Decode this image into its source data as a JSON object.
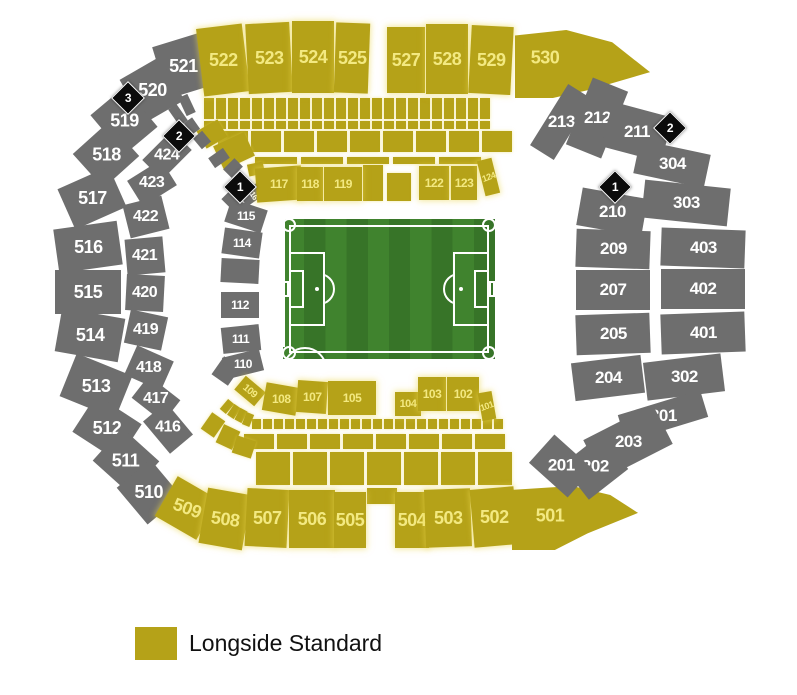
{
  "legend": {
    "label": "Longside Standard",
    "swatch_color": "#b5a218"
  },
  "colors": {
    "longside_standard": "#b5a218",
    "unavailable_gray": "#6e6e6e",
    "yellow_label_text": "#f3e981",
    "gray_label_text": "#ffffff",
    "marker_bg": "#0b0b0b",
    "pitch_green_light": "#40832e",
    "pitch_green_dark": "#377428",
    "pitch_line": "#ffffff"
  },
  "pitch": {
    "x": 283,
    "y": 219,
    "w": 212,
    "h": 140
  },
  "markers": [
    {
      "label": "3",
      "cx": 127,
      "cy": 97
    },
    {
      "label": "2",
      "cx": 178,
      "cy": 135
    },
    {
      "label": "1",
      "cx": 239,
      "cy": 186
    },
    {
      "label": "2",
      "cx": 669,
      "cy": 127
    },
    {
      "label": "1",
      "cx": 614,
      "cy": 186
    }
  ],
  "sections": [
    {
      "label": "521",
      "cx": 183,
      "cy": 66,
      "w": 48,
      "h": 54,
      "r": -17,
      "c": "g",
      "fs": 18
    },
    {
      "label": "522",
      "cx": 223,
      "cy": 60,
      "w": 46,
      "h": 68,
      "r": -7,
      "c": "y",
      "fs": 18
    },
    {
      "label": "523",
      "cx": 269,
      "cy": 58,
      "w": 44,
      "h": 70,
      "r": -3,
      "c": "y",
      "fs": 18
    },
    {
      "label": "524",
      "cx": 313,
      "cy": 57,
      "w": 42,
      "h": 72,
      "r": 0,
      "c": "y",
      "fs": 18
    },
    {
      "label": "525",
      "cx": 352,
      "cy": 58,
      "w": 34,
      "h": 70,
      "r": 2,
      "c": "y",
      "fs": 18
    },
    {
      "label": "527",
      "cx": 406,
      "cy": 60,
      "w": 38,
      "h": 66,
      "r": 0,
      "c": "y",
      "fs": 18
    },
    {
      "label": "528",
      "cx": 447,
      "cy": 59,
      "w": 42,
      "h": 70,
      "r": 0,
      "c": "y",
      "fs": 18
    },
    {
      "label": "529",
      "cx": 491,
      "cy": 60,
      "w": 42,
      "h": 68,
      "r": 3,
      "c": "y",
      "fs": 18
    },
    {
      "label": "530",
      "x": 515,
      "y": 30,
      "w": 135,
      "h": 68,
      "c": "y",
      "fs": 18,
      "poly": "polygon(0% 8%, 38% 0%, 72% 18%, 100% 62%, 55% 88%, 28% 100%, 0% 100%)",
      "lp": [
        30,
        28
      ]
    },
    {
      "label": "520",
      "cx": 152,
      "cy": 90,
      "w": 46,
      "h": 50,
      "r": -30,
      "c": "g",
      "fs": 18
    },
    {
      "label": "519",
      "cx": 124,
      "cy": 121,
      "w": 44,
      "h": 52,
      "r": -40,
      "c": "g",
      "fs": 18
    },
    {
      "label": "518",
      "cx": 106,
      "cy": 155,
      "w": 48,
      "h": 46,
      "r": -42,
      "c": "g",
      "fs": 18
    },
    {
      "label": "517",
      "cx": 92,
      "cy": 198,
      "w": 56,
      "h": 44,
      "r": -24,
      "c": "g",
      "fs": 18
    },
    {
      "label": "516",
      "cx": 88,
      "cy": 247,
      "w": 64,
      "h": 44,
      "r": -8,
      "c": "g",
      "fs": 18
    },
    {
      "label": "515",
      "cx": 88,
      "cy": 292,
      "w": 66,
      "h": 44,
      "r": 0,
      "c": "g",
      "fs": 18
    },
    {
      "label": "514",
      "cx": 90,
      "cy": 335,
      "w": 64,
      "h": 44,
      "r": 10,
      "c": "g",
      "fs": 18
    },
    {
      "label": "513",
      "cx": 96,
      "cy": 386,
      "w": 60,
      "h": 46,
      "r": 22,
      "c": "g",
      "fs": 18
    },
    {
      "label": "512",
      "cx": 107,
      "cy": 428,
      "w": 54,
      "h": 44,
      "r": 33,
      "c": "g",
      "fs": 18
    },
    {
      "label": "511",
      "cx": 126,
      "cy": 461,
      "w": 50,
      "h": 44,
      "r": 42,
      "c": "g",
      "fs": 18
    },
    {
      "label": "510",
      "cx": 149,
      "cy": 492,
      "w": 48,
      "h": 44,
      "r": 50,
      "c": "g",
      "fs": 18
    },
    {
      "label": "509",
      "cx": 187,
      "cy": 508,
      "w": 48,
      "h": 46,
      "r": 30,
      "c": "y",
      "fs": 18,
      "lr": 20
    },
    {
      "label": "508",
      "cx": 225,
      "cy": 519,
      "w": 44,
      "h": 56,
      "r": 10,
      "c": "y",
      "fs": 18,
      "lr": 8
    },
    {
      "label": "507",
      "cx": 267,
      "cy": 518,
      "w": 42,
      "h": 58,
      "r": 3,
      "c": "y",
      "fs": 18
    },
    {
      "label": "506",
      "cx": 312,
      "cy": 519,
      "w": 46,
      "h": 58,
      "r": 0,
      "c": "y",
      "fs": 18
    },
    {
      "label": "505",
      "cx": 350,
      "cy": 520,
      "w": 32,
      "h": 56,
      "r": 0,
      "c": "y",
      "fs": 18
    },
    {
      "label": "504",
      "cx": 412,
      "cy": 520,
      "w": 34,
      "h": 56,
      "r": 0,
      "c": "y",
      "fs": 18
    },
    {
      "label": "503",
      "cx": 448,
      "cy": 518,
      "w": 46,
      "h": 58,
      "r": -2,
      "c": "y",
      "fs": 18
    },
    {
      "label": "502",
      "cx": 494,
      "cy": 517,
      "w": 44,
      "h": 58,
      "r": -5,
      "c": "y",
      "fs": 18
    },
    {
      "label": "501",
      "x": 512,
      "y": 486,
      "w": 126,
      "h": 64,
      "c": "y",
      "fs": 18,
      "poly": "polygon(0% 6%, 48% 0%, 78% 14%, 100% 42%, 60% 74%, 34% 100%, 0% 100%)",
      "lp": [
        38,
        30
      ]
    },
    {
      "label": "213",
      "cx": 561,
      "cy": 122,
      "w": 28,
      "h": 72,
      "r": 32,
      "c": "g",
      "fs": 17
    },
    {
      "label": "212",
      "cx": 597,
      "cy": 118,
      "w": 38,
      "h": 72,
      "r": 22,
      "c": "g",
      "fs": 17
    },
    {
      "label": "211",
      "cx": 637,
      "cy": 132,
      "w": 62,
      "h": 46,
      "r": 15,
      "c": "g",
      "fs": 17
    },
    {
      "label": "304",
      "cx": 672,
      "cy": 164,
      "w": 72,
      "h": 34,
      "r": 12,
      "c": "g",
      "fs": 17
    },
    {
      "label": "303",
      "cx": 686,
      "cy": 203,
      "w": 86,
      "h": 38,
      "r": 6,
      "c": "g",
      "fs": 17
    },
    {
      "label": "210",
      "cx": 612,
      "cy": 212,
      "w": 66,
      "h": 38,
      "r": 10,
      "c": "g",
      "fs": 17
    },
    {
      "label": "209",
      "cx": 613,
      "cy": 249,
      "w": 74,
      "h": 38,
      "r": 2,
      "c": "g",
      "fs": 17
    },
    {
      "label": "403",
      "cx": 703,
      "cy": 248,
      "w": 84,
      "h": 38,
      "r": 2,
      "c": "g",
      "fs": 17
    },
    {
      "label": "207",
      "cx": 613,
      "cy": 290,
      "w": 74,
      "h": 40,
      "r": 0,
      "c": "g",
      "fs": 17
    },
    {
      "label": "402",
      "cx": 703,
      "cy": 289,
      "w": 84,
      "h": 40,
      "r": 0,
      "c": "g",
      "fs": 17
    },
    {
      "label": "205",
      "cx": 613,
      "cy": 334,
      "w": 74,
      "h": 40,
      "r": -2,
      "c": "g",
      "fs": 17
    },
    {
      "label": "401",
      "cx": 703,
      "cy": 333,
      "w": 84,
      "h": 40,
      "r": -2,
      "c": "g",
      "fs": 17
    },
    {
      "label": "204",
      "cx": 608,
      "cy": 378,
      "w": 70,
      "h": 38,
      "r": -7,
      "c": "g",
      "fs": 17
    },
    {
      "label": "302",
      "cx": 684,
      "cy": 377,
      "w": 78,
      "h": 38,
      "r": -7,
      "c": "g",
      "fs": 17
    },
    {
      "label": "301",
      "cx": 663,
      "cy": 416,
      "w": 86,
      "h": 28,
      "r": -17,
      "c": "g",
      "fs": 17
    },
    {
      "label": "203",
      "cx": 628,
      "cy": 442,
      "w": 78,
      "h": 44,
      "r": -27,
      "c": "g",
      "fs": 17
    },
    {
      "label": "202",
      "cx": 595,
      "cy": 467,
      "w": 50,
      "h": 44,
      "r": -38,
      "c": "g",
      "fs": 17
    },
    {
      "label": "201",
      "cx": 561,
      "cy": 466,
      "w": 38,
      "h": 52,
      "r": -48,
      "c": "g",
      "fs": 17
    },
    {
      "label": "424",
      "cx": 167,
      "cy": 155,
      "w": 42,
      "h": 28,
      "r": -45,
      "c": "g",
      "fs": 16
    },
    {
      "label": "423",
      "cx": 152,
      "cy": 183,
      "w": 40,
      "h": 30,
      "r": -32,
      "c": "g",
      "fs": 16
    },
    {
      "label": "422",
      "cx": 146,
      "cy": 217,
      "w": 40,
      "h": 34,
      "r": -14,
      "c": "g",
      "fs": 16
    },
    {
      "label": "421",
      "cx": 145,
      "cy": 256,
      "w": 38,
      "h": 36,
      "r": -5,
      "c": "g",
      "fs": 16
    },
    {
      "label": "420",
      "cx": 145,
      "cy": 293,
      "w": 38,
      "h": 36,
      "r": 3,
      "c": "g",
      "fs": 16
    },
    {
      "label": "419",
      "cx": 146,
      "cy": 330,
      "w": 38,
      "h": 34,
      "r": 12,
      "c": "g",
      "fs": 16
    },
    {
      "label": "418",
      "cx": 149,
      "cy": 368,
      "w": 40,
      "h": 32,
      "r": 24,
      "c": "g",
      "fs": 16
    },
    {
      "label": "417",
      "cx": 156,
      "cy": 399,
      "w": 40,
      "h": 28,
      "r": 38,
      "c": "g",
      "fs": 16
    },
    {
      "label": "416",
      "cx": 168,
      "cy": 428,
      "w": 42,
      "h": 30,
      "r": 50,
      "c": "g",
      "fs": 16
    },
    {
      "label": "116",
      "cx": 253,
      "cy": 194,
      "w": 14,
      "h": 24,
      "r": 55,
      "c": "g",
      "fs": 8,
      "lr": 55
    },
    {
      "label": "115",
      "cx": 246,
      "cy": 216,
      "w": 38,
      "h": 24,
      "r": 18,
      "c": "g",
      "fs": 12
    },
    {
      "label": "114",
      "cx": 242,
      "cy": 243,
      "w": 38,
      "h": 26,
      "r": 8,
      "c": "g",
      "fs": 12
    },
    {
      "label": "112",
      "cx": 240,
      "cy": 305,
      "w": 38,
      "h": 26,
      "r": 0,
      "c": "g",
      "fs": 12
    },
    {
      "label": "111",
      "cx": 241,
      "cy": 339,
      "w": 38,
      "h": 26,
      "r": -6,
      "c": "g",
      "fs": 12
    },
    {
      "label": "110",
      "cx": 243,
      "cy": 364,
      "w": 38,
      "h": 22,
      "r": -14,
      "c": "g",
      "fs": 12
    },
    {
      "label": "117",
      "cx": 279,
      "cy": 184,
      "w": 46,
      "h": 34,
      "r": -4,
      "c": "y",
      "fs": 12
    },
    {
      "label": "118",
      "cx": 310,
      "cy": 184,
      "w": 26,
      "h": 34,
      "r": 0,
      "c": "y",
      "fs": 12
    },
    {
      "label": "119",
      "cx": 343,
      "cy": 184,
      "w": 38,
      "h": 34,
      "r": 0,
      "c": "y",
      "fs": 12
    },
    {
      "label": "122",
      "cx": 434,
      "cy": 183,
      "w": 30,
      "h": 34,
      "r": 0,
      "c": "y",
      "fs": 12
    },
    {
      "label": "123",
      "cx": 464,
      "cy": 183,
      "w": 26,
      "h": 34,
      "r": 0,
      "c": "y",
      "fs": 12
    },
    {
      "label": "124",
      "cx": 488,
      "cy": 177,
      "w": 15,
      "h": 36,
      "r": -14,
      "c": "y",
      "fs": 9,
      "lr": -20
    },
    {
      "label": "109",
      "cx": 250,
      "cy": 391,
      "w": 26,
      "h": 18,
      "r": 40,
      "c": "y",
      "fs": 10,
      "lr": 40
    },
    {
      "label": "108",
      "cx": 281,
      "cy": 399,
      "w": 34,
      "h": 28,
      "r": 10,
      "c": "y",
      "fs": 12
    },
    {
      "label": "107",
      "cx": 312,
      "cy": 397,
      "w": 30,
      "h": 32,
      "r": 4,
      "c": "y",
      "fs": 12
    },
    {
      "label": "105",
      "cx": 352,
      "cy": 398,
      "w": 48,
      "h": 34,
      "r": 0,
      "c": "y",
      "fs": 12
    },
    {
      "label": "104",
      "cx": 408,
      "cy": 404,
      "w": 26,
      "h": 24,
      "r": 0,
      "c": "y",
      "fs": 11
    },
    {
      "label": "103",
      "cx": 432,
      "cy": 394,
      "w": 28,
      "h": 34,
      "r": 0,
      "c": "y",
      "fs": 12
    },
    {
      "label": "102",
      "cx": 463,
      "cy": 394,
      "w": 32,
      "h": 34,
      "r": 0,
      "c": "y",
      "fs": 12
    },
    {
      "label": "101",
      "cx": 487,
      "cy": 406,
      "w": 14,
      "h": 28,
      "r": -10,
      "c": "y",
      "fs": 9,
      "lr": -20
    }
  ],
  "fillers": [
    {
      "cx": 382,
      "cy": 496,
      "w": 30,
      "h": 16,
      "r": 0,
      "c": "y"
    },
    {
      "cx": 373,
      "cy": 183,
      "w": 20,
      "h": 36,
      "r": 0,
      "c": "y"
    },
    {
      "cx": 399,
      "cy": 187,
      "w": 24,
      "h": 28,
      "r": 0,
      "c": "y"
    },
    {
      "cx": 212,
      "cy": 134,
      "w": 24,
      "h": 20,
      "r": -30,
      "c": "y"
    },
    {
      "cx": 234,
      "cy": 151,
      "w": 34,
      "h": 26,
      "r": -25,
      "c": "y"
    },
    {
      "cx": 256,
      "cy": 169,
      "w": 16,
      "h": 12,
      "r": -12,
      "c": "y"
    },
    {
      "cx": 213,
      "cy": 425,
      "w": 16,
      "h": 20,
      "r": 35,
      "c": "y"
    },
    {
      "cx": 228,
      "cy": 437,
      "w": 18,
      "h": 20,
      "r": 25,
      "c": "y"
    },
    {
      "cx": 244,
      "cy": 447,
      "w": 20,
      "h": 18,
      "r": 18,
      "c": "y"
    },
    {
      "cx": 227,
      "cy": 406,
      "w": 8,
      "h": 13,
      "r": 40,
      "c": "y"
    },
    {
      "cx": 234,
      "cy": 411,
      "w": 8,
      "h": 13,
      "r": 34,
      "c": "y"
    },
    {
      "cx": 241,
      "cy": 415,
      "w": 8,
      "h": 13,
      "r": 28,
      "c": "y"
    },
    {
      "cx": 248,
      "cy": 419,
      "w": 8,
      "h": 13,
      "r": 22,
      "c": "y"
    },
    {
      "cx": 240,
      "cy": 271,
      "w": 38,
      "h": 24,
      "r": 3,
      "c": "g"
    },
    {
      "cx": 232,
      "cy": 197,
      "w": 12,
      "h": 18,
      "r": 45,
      "c": "g"
    },
    {
      "cx": 226,
      "cy": 371,
      "w": 20,
      "h": 22,
      "r": 35,
      "c": "g"
    },
    {
      "cx": 187,
      "cy": 105,
      "w": 10,
      "h": 20,
      "r": -25,
      "c": "g"
    },
    {
      "cx": 178,
      "cy": 115,
      "w": 10,
      "h": 20,
      "r": -35,
      "c": "g"
    },
    {
      "cx": 192,
      "cy": 126,
      "w": 10,
      "h": 14,
      "r": -35,
      "c": "g"
    },
    {
      "cx": 202,
      "cy": 140,
      "w": 12,
      "h": 14,
      "r": -40,
      "c": "g"
    },
    {
      "cx": 219,
      "cy": 158,
      "w": 18,
      "h": 12,
      "r": -35,
      "c": "g"
    },
    {
      "cx": 233,
      "cy": 168,
      "w": 16,
      "h": 12,
      "r": -45,
      "c": "g"
    }
  ],
  "strips": [
    {
      "x": 204,
      "y": 98,
      "w": 10,
      "h": 21,
      "gap": 2,
      "count": 24,
      "c": "y"
    },
    {
      "x": 204,
      "y": 121,
      "w": 10,
      "h": 8,
      "gap": 2,
      "count": 24,
      "c": "y"
    },
    {
      "x": 218,
      "y": 131,
      "w": 30,
      "h": 21,
      "gap": 3,
      "count": 9,
      "c": "y"
    },
    {
      "x": 255,
      "y": 157,
      "w": 42,
      "h": 7,
      "gap": 4,
      "count": 5,
      "c": "y"
    },
    {
      "x": 252,
      "y": 419,
      "w": 9,
      "h": 10,
      "gap": 2,
      "count": 23,
      "c": "y"
    },
    {
      "x": 244,
      "y": 434,
      "w": 30,
      "h": 15,
      "gap": 3,
      "count": 8,
      "c": "y"
    },
    {
      "x": 256,
      "y": 452,
      "w": 34,
      "h": 33,
      "gap": 3,
      "count": 7,
      "c": "y"
    }
  ]
}
